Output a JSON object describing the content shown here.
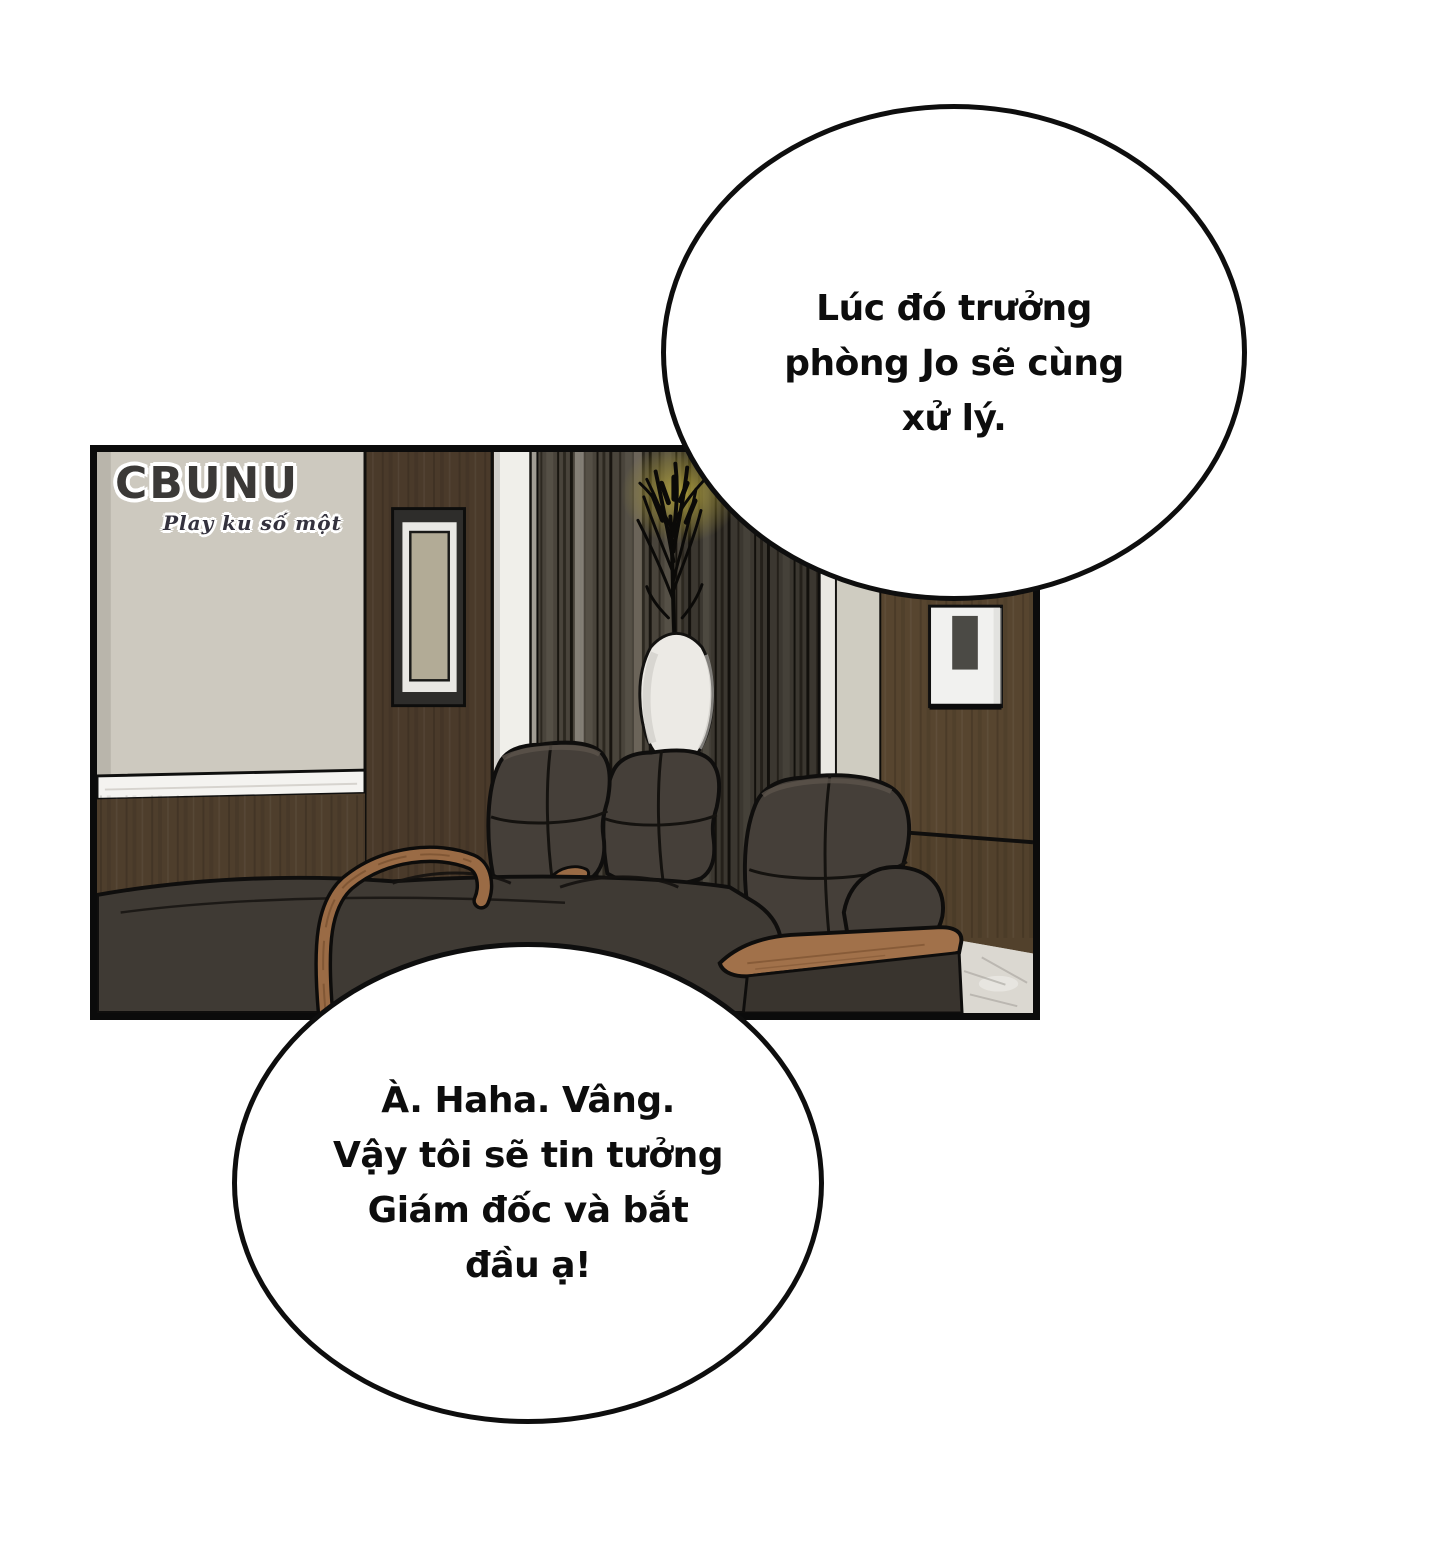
{
  "watermark": {
    "brand": "CBUNU",
    "tagline": "Play ku số một"
  },
  "bubbles": {
    "top": {
      "lines": [
        "Lúc đó trưởng",
        "phòng Jo sẽ cùng",
        "xử lý."
      ]
    },
    "bottom": {
      "lines": [
        "À. Haha. Vâng.",
        "Vậy tôi sẽ tin tưởng",
        "Giám đốc và bắt",
        "đầu ạ!"
      ]
    }
  },
  "colors": {
    "page_background": "#ffffff",
    "panel_border": "#0b0b0b",
    "bubble_fill": "#ffffff",
    "bubble_border": "#0e0e0e",
    "text": "#0d0d0d",
    "beige_wall": "#cdc9bf",
    "wood_dark": "#4a3a2a",
    "wood_wall_right": "#57452f",
    "wainscot": "#4e3e2c",
    "curtain_base": "#49443b",
    "pillar_white": "#f0efea",
    "sill_marble": "#f4f3f0",
    "marble_floor": "#dbd8d1",
    "chair_leather": "#453f39",
    "chair_seat_mass": "#3f3a34",
    "armrest_wood": "#9a6b45",
    "glass_table": "#474440",
    "glow_accent": "#b8a83f",
    "watermark_brand_color": "#3b3937"
  }
}
